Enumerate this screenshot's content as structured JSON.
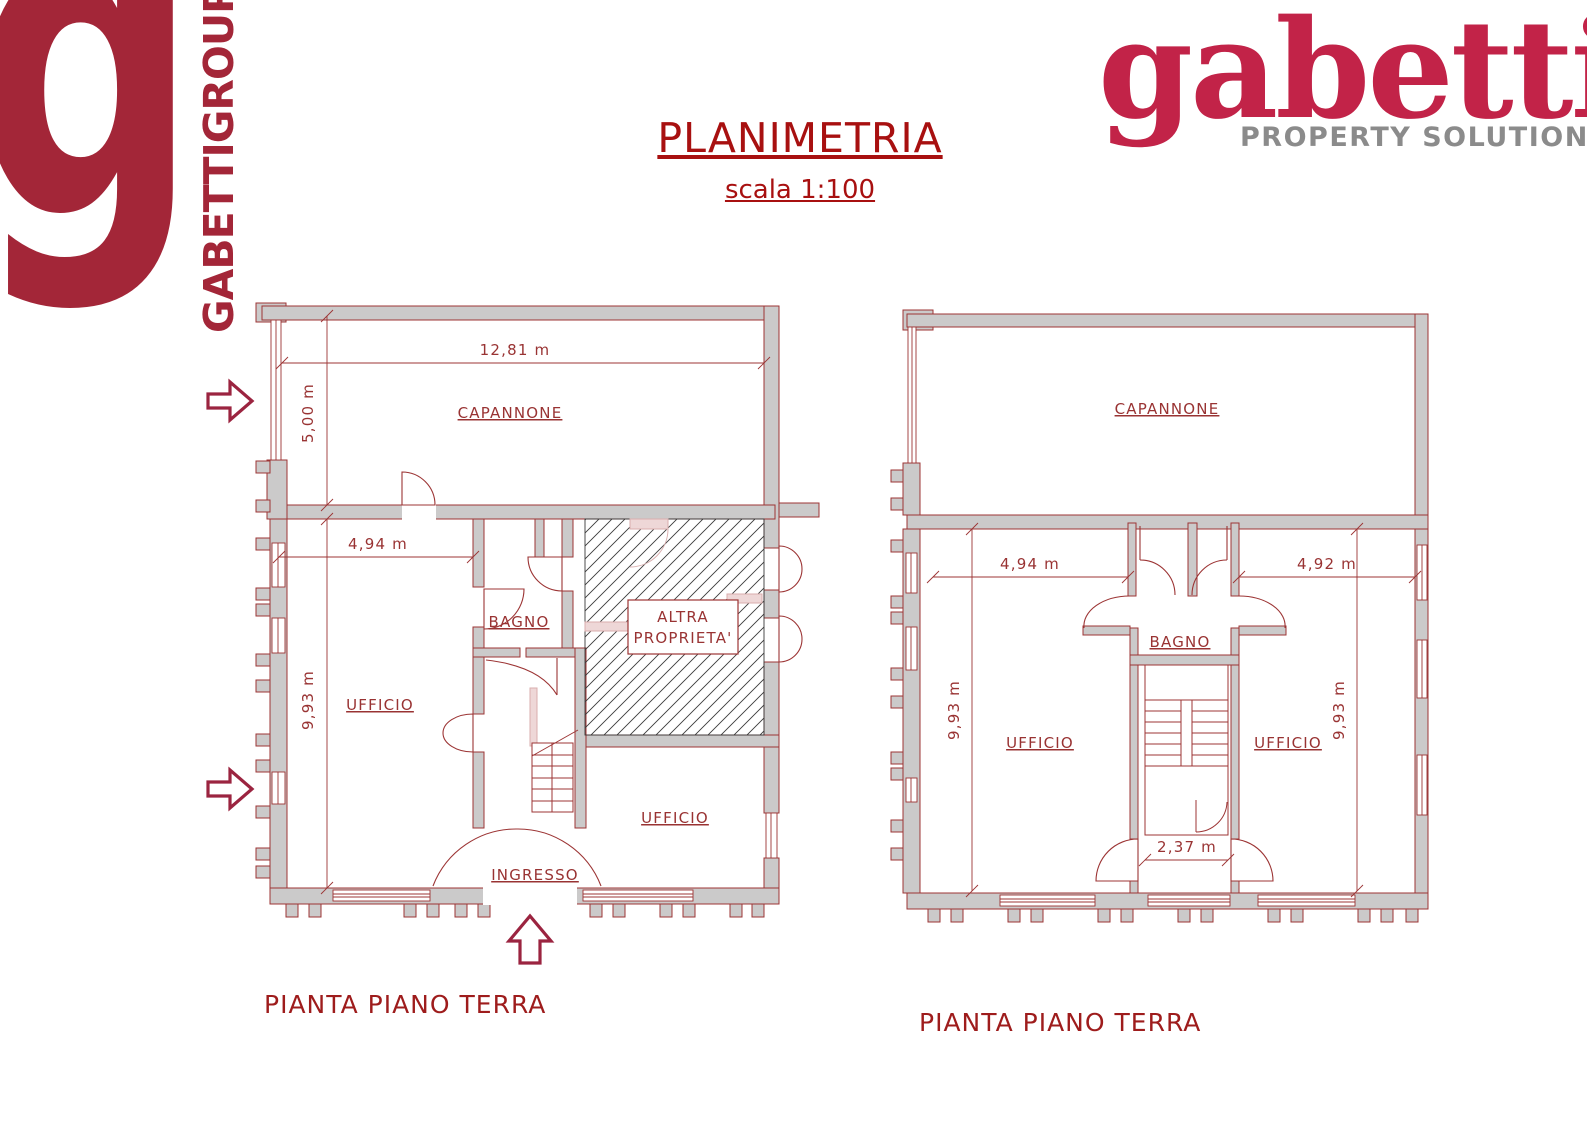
{
  "branding": {
    "group": {
      "letter": "g",
      "name": "GABETTIGROUP",
      "color": "#a32638"
    },
    "property": {
      "wordmark": "gabetti",
      "tagline": "PROPERTY SOLUTIONS",
      "wordmark_color": "#c22348",
      "tagline_color": "#8b8b8b"
    }
  },
  "header": {
    "title": "PLANIMETRIA",
    "scale": "scala 1:100",
    "color": "#a81010"
  },
  "plan_left": {
    "caption": "PIANTA PIANO TERRA",
    "room_capannone": "CAPANNONE",
    "room_bagno": "BAGNO",
    "room_ufficio_main": "UFFICIO",
    "room_ufficio_secondary": "UFFICIO",
    "room_ingresso": "INGRESSO",
    "other_property_line1": "ALTRA",
    "other_property_line2": "PROPRIETA'",
    "dim_capannone_width": "12,81 m",
    "dim_capannone_height": "5,00 m",
    "dim_ufficio_width": "4,94 m",
    "dim_ufficio_height": "9,93 m"
  },
  "plan_right": {
    "caption": "PIANTA PIANO TERRA",
    "room_capannone": "CAPANNONE",
    "room_bagno": "BAGNO",
    "room_ufficio_left": "UFFICIO",
    "room_ufficio_right": "UFFICIO",
    "dim_ufficio_left_width": "4,94 m",
    "dim_ufficio_right_width": "4,92 m",
    "dim_ufficio_left_height": "9,93 m",
    "dim_ufficio_right_height": "9,93 m",
    "dim_stair_width": "2,37 m"
  },
  "colors": {
    "wall_fill": "#cbcaca",
    "plan_stroke": "#9c3434",
    "label_text": "#993333",
    "hatch": "#3a3a3a"
  }
}
